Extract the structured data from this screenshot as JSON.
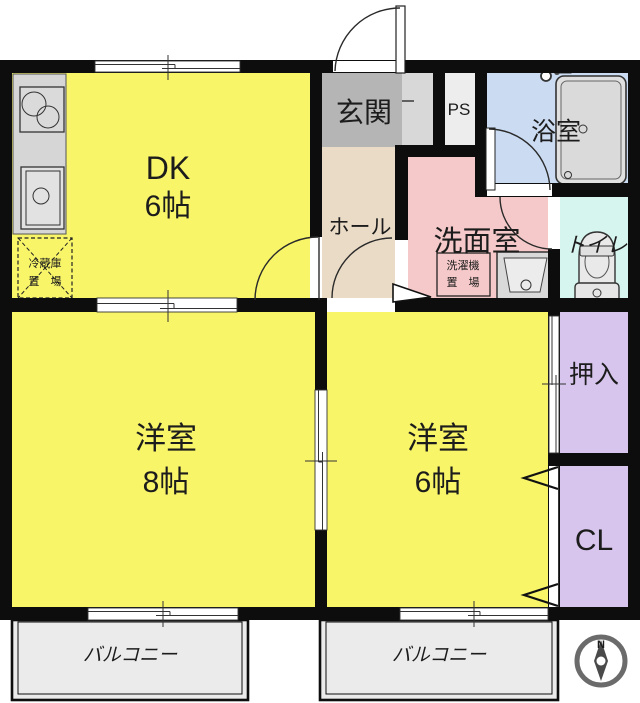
{
  "plan": {
    "rooms": {
      "dk": {
        "label": "DK",
        "size": "6帖"
      },
      "entry": {
        "label": "玄関"
      },
      "hall": {
        "label": "ホール"
      },
      "ps": {
        "label": "PS"
      },
      "bath": {
        "label": "浴室"
      },
      "washroom": {
        "label": "洗面室"
      },
      "toilet": {
        "label": "トイレ"
      },
      "west8": {
        "label": "洋室",
        "size": "8帖"
      },
      "west6": {
        "label": "洋室",
        "size": "6帖"
      },
      "oshiire": {
        "label": "押入"
      },
      "cl": {
        "label": "CL"
      },
      "balcony_left": {
        "label": "バルコニー"
      },
      "balcony_right": {
        "label": "バルコニー"
      }
    },
    "fixtures": {
      "fridge": {
        "line1": "冷蔵庫",
        "line2": "置　場"
      },
      "washer": {
        "line1": "洗濯機",
        "line2": "置　場"
      }
    },
    "compass": {
      "north": "N"
    }
  },
  "colors": {
    "room_yellow": "#f8f569",
    "hall_beige": "#eadbc6",
    "entry_gray": "#b5b5b5",
    "entry_step_gray": "#d8d8d8",
    "ps_fill": "#ededed",
    "washroom_pink": "#f5c9c9",
    "bath_blue": "#cbdcf2",
    "toilet_cyan": "#d7f5ef",
    "closet_lavender": "#d8c5ee",
    "balcony_gray": "#ebebeb",
    "fixture_gray": "#d9d9d9",
    "wall_black": "#0d0d0d",
    "compass_gray": "#6b6b6b"
  }
}
